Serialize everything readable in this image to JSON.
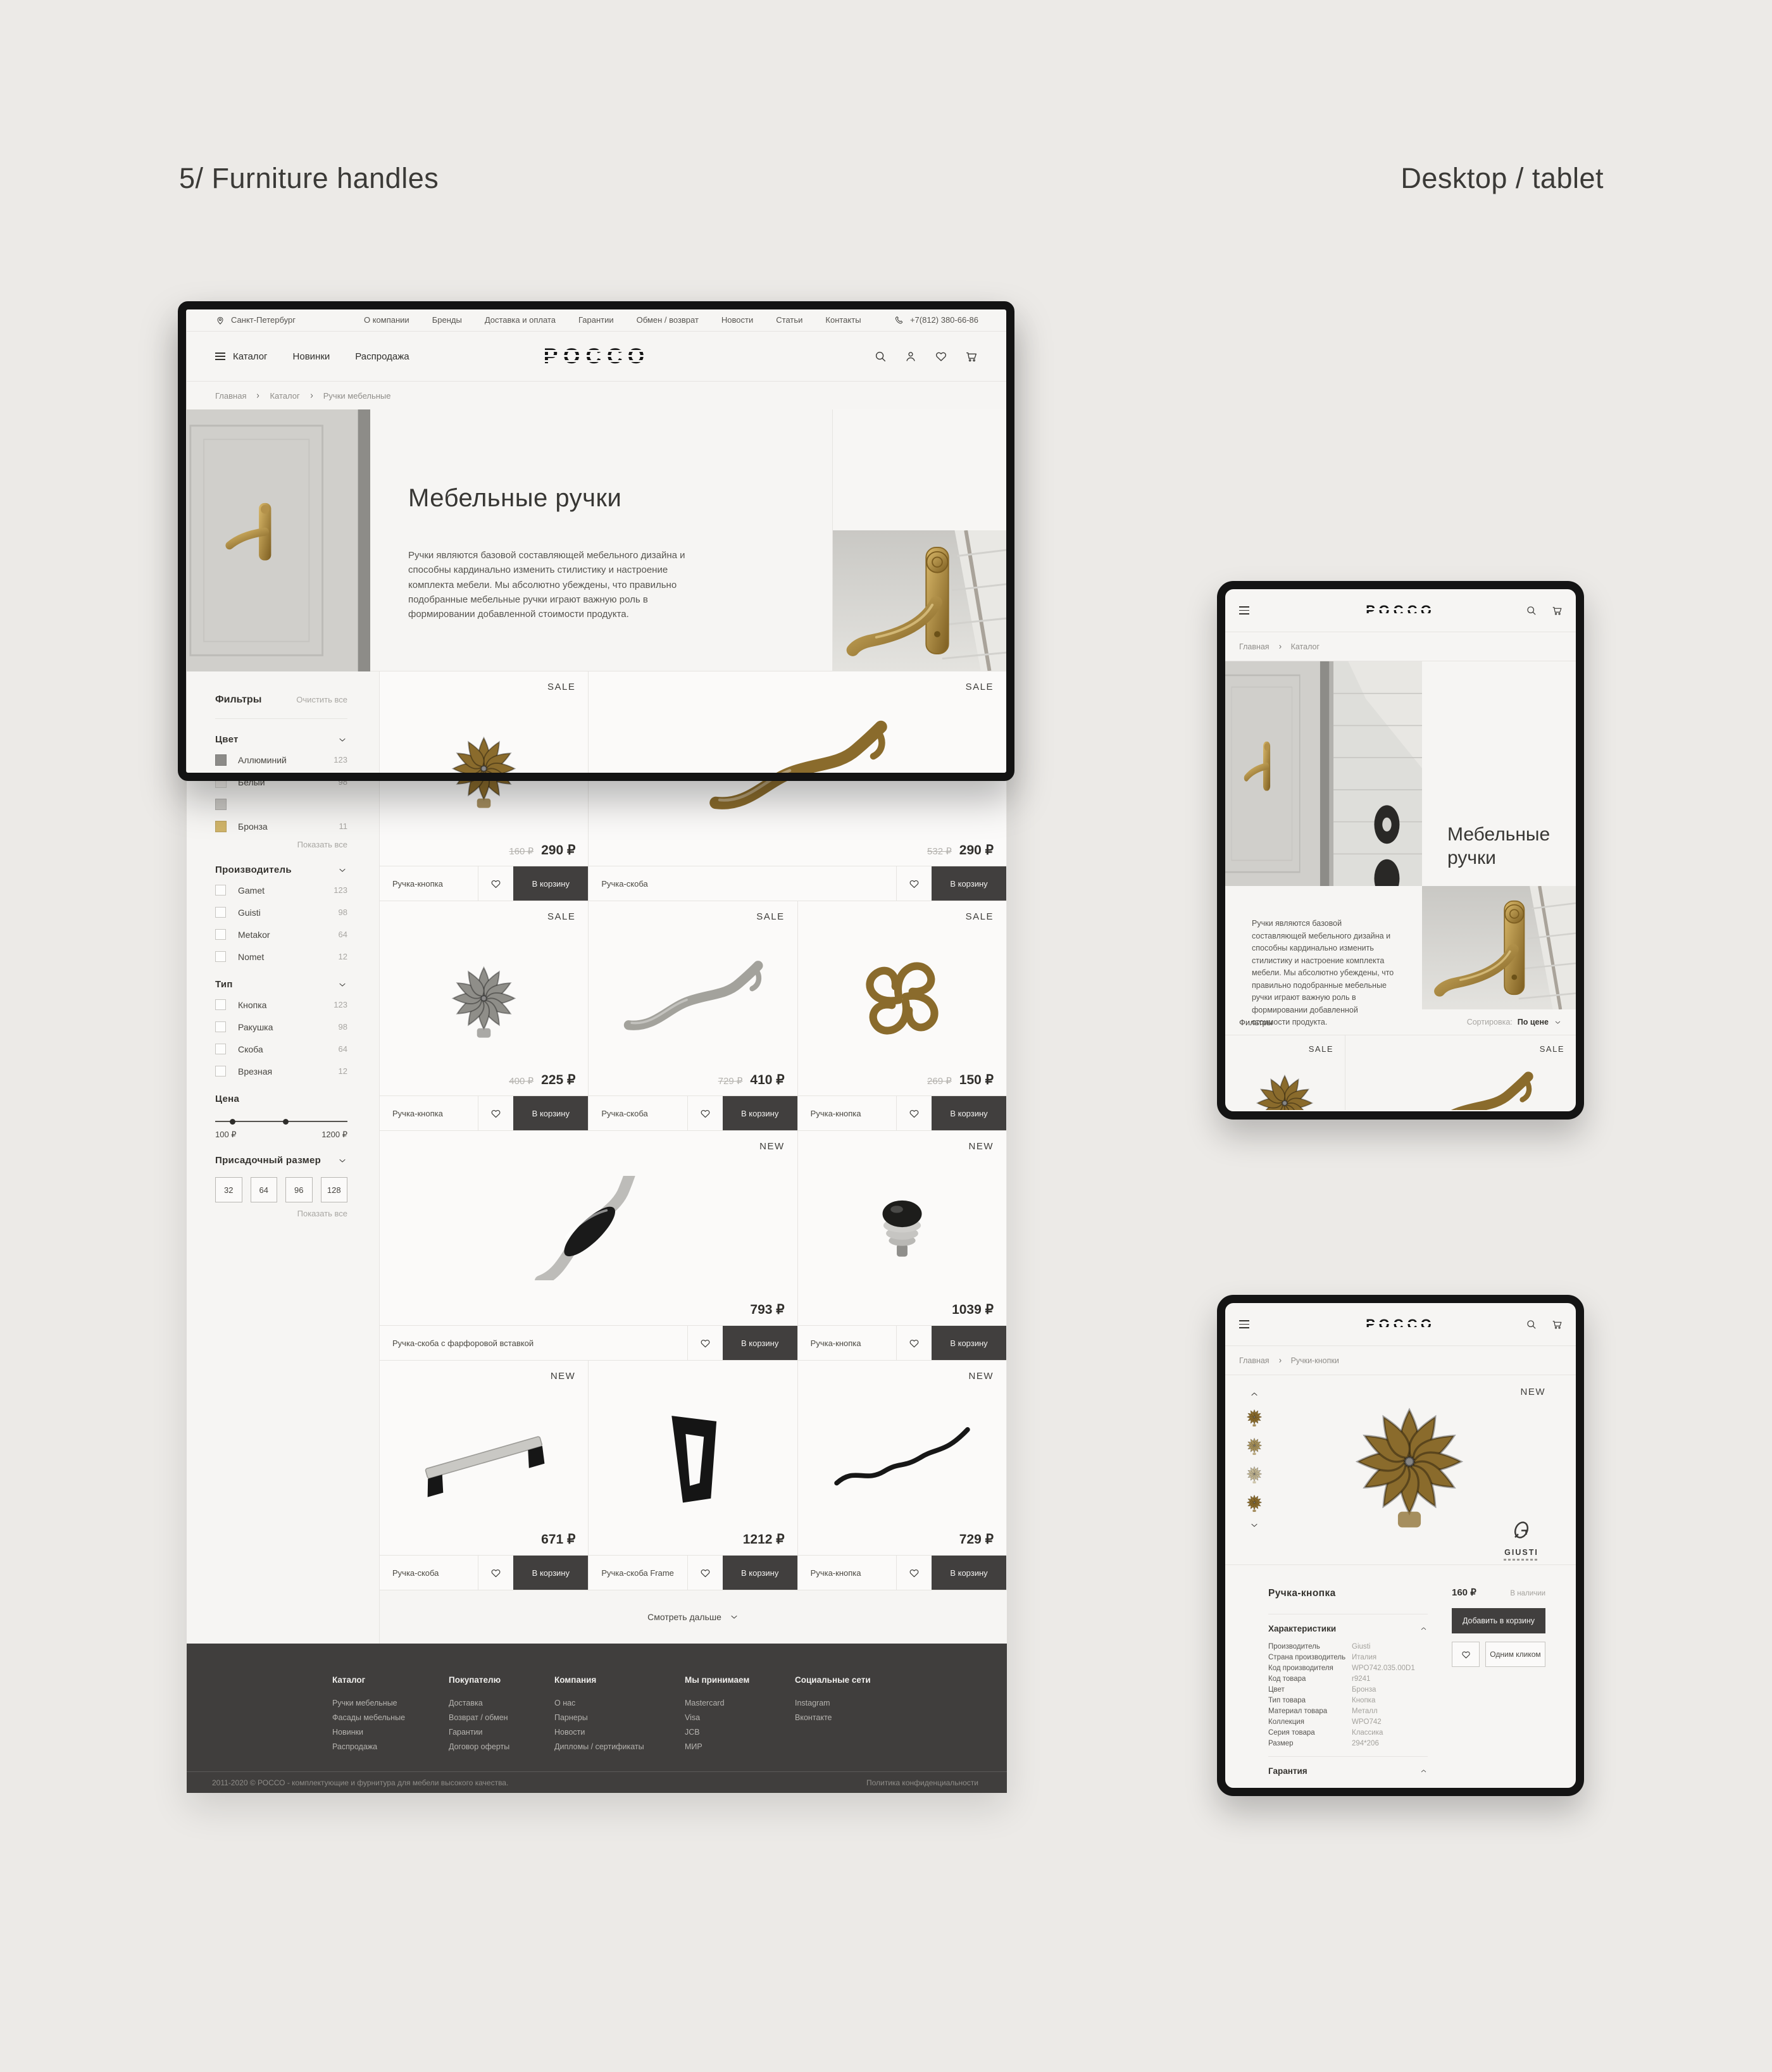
{
  "meta": {
    "title": "5/ Furniture handles",
    "device_label": "Desktop / tablet"
  },
  "topbar": {
    "city": "Санкт-Петербург",
    "links": [
      "О компании",
      "Бренды",
      "Доставка и оплата",
      "Гарантии",
      "Обмен / возврат",
      "Новости",
      "Статьи",
      "Контакты"
    ],
    "phone": "+7(812) 380-66-86"
  },
  "nav": {
    "logo": "РОССО",
    "items": [
      "Каталог",
      "Новинки",
      "Распродажа"
    ]
  },
  "breadcrumb": [
    "Главная",
    "Каталог",
    "Ручки мебельные"
  ],
  "hero": {
    "title": "Мебельные ручки",
    "description": "Ручки являются базовой составляющей мебельного дизайна и способны кардинально изменить стилистику и настроение комплекта мебели. Мы абсолютно убеждены, что правильно подобранные мебельные ручки играют важную роль в формировании добавленной стоимости продукта."
  },
  "filters": {
    "title": "Фильтры",
    "clear_all": "Очистить все",
    "show_all": "Показать все",
    "color": {
      "title": "Цвет",
      "items": [
        {
          "label": "Аллюминий",
          "count": "123",
          "swatch": "#8c8b88"
        },
        {
          "label": "Белый",
          "count": "98",
          "swatch": "#edebe7"
        },
        {
          "label": "",
          "count": "",
          "swatch": "#c9c7c3"
        },
        {
          "label": "Бронза",
          "count": "11",
          "swatch": "#d0b469"
        }
      ]
    },
    "manufacturer": {
      "title": "Производитель",
      "items": [
        {
          "label": "Gamet",
          "count": "123"
        },
        {
          "label": "Guisti",
          "count": "98"
        },
        {
          "label": "Metakor",
          "count": "64"
        },
        {
          "label": "Nomet",
          "count": "12"
        }
      ]
    },
    "type": {
      "title": "Тип",
      "items": [
        {
          "label": "Кнопка",
          "count": "123"
        },
        {
          "label": "Ракушка",
          "count": "98"
        },
        {
          "label": "Скоба",
          "count": "64"
        },
        {
          "label": "Врезная",
          "count": "12"
        }
      ]
    },
    "price": {
      "title": "Цена",
      "min": "100 ₽",
      "max": "1200 ₽"
    },
    "size": {
      "title": "Присадочный размер",
      "options": [
        "32",
        "64",
        "96",
        "128"
      ]
    }
  },
  "products": {
    "add_to_cart": "В корзину",
    "load_more": "Смотреть дальше",
    "items": [
      {
        "badge": "SALE",
        "old_price": "160 ₽",
        "price": "290 ₽",
        "label": "Ручка-кнопка",
        "img": "knob-flower-brass"
      },
      {
        "badge": "SALE",
        "old_price": "532 ₽",
        "price": "290 ₽",
        "label": "Ручка-скоба",
        "img": "handle-curve-brass"
      },
      {
        "badge": "SALE",
        "old_price": "400 ₽",
        "price": "225 ₽",
        "label": "Ручка-кнопка",
        "img": "knob-flower-silver"
      },
      {
        "badge": "SALE",
        "old_price": "729 ₽",
        "price": "410 ₽",
        "label": "Ручка-скоба",
        "img": "handle-curve-silver"
      },
      {
        "badge": "SALE",
        "old_price": "269 ₽",
        "price": "150 ₽",
        "label": "Ручка-кнопка",
        "img": "knob-ornate-brass"
      },
      {
        "badge": "NEW",
        "old_price": "",
        "price": "793 ₽",
        "label": "Ручка-скоба с фарфоровой вставкой",
        "img": "handle-porcelain-chrome"
      },
      {
        "badge": "NEW",
        "old_price": "",
        "price": "1039 ₽",
        "label": "Ручка-кнопка",
        "img": "knob-chrome-black"
      },
      {
        "badge": "NEW",
        "old_price": "",
        "price": "671 ₽",
        "label": "Ручка-скоба",
        "img": "handle-bar-steel"
      },
      {
        "badge": "",
        "old_price": "",
        "price": "1212 ₽",
        "label": "Ручка-скоба Frame",
        "img": "handle-frame-black"
      },
      {
        "badge": "NEW",
        "old_price": "",
        "price": "729 ₽",
        "label": "Ручка-кнопка",
        "img": "handle-wave-black"
      }
    ]
  },
  "footer": {
    "columns": [
      {
        "title": "Каталог",
        "links": [
          "Ручки мебельные",
          "Фасады мебельные",
          "Новинки",
          "Распродажа"
        ]
      },
      {
        "title": "Покупателю",
        "links": [
          "Доставка",
          "Возврат / обмен",
          "Гарантии",
          "Договор оферты"
        ]
      },
      {
        "title": "Компания",
        "links": [
          "О нас",
          "Парнеры",
          "Новости",
          "Дипломы / сертификаты"
        ]
      },
      {
        "title": "Мы принимаем",
        "links": [
          "Mastercard",
          "Visa",
          "JCB",
          "МИР"
        ]
      },
      {
        "title": "Социальные сети",
        "links": [
          "Instagram",
          "Вконтакте"
        ]
      }
    ],
    "copyright": "2011-2020 © РОССО - комплектующие и фурнитура для мебели высокого качества.",
    "privacy": "Политика конфиденциальности"
  },
  "tablet_catalog": {
    "breadcrumb": [
      "Главная",
      "Каталог"
    ],
    "title": "Мебельные ручки",
    "description": "Ручки являются базовой составляющей мебельного дизайна и способны кардинально изменить стилистику и настроение комплекта мебели. Мы абсолютно убеждены, что правильно подобранные мебельные ручки играют важную роль в формировании добавленной стоимости продукта.",
    "filters_label": "Фильтры",
    "sort_label": "Сортировка:",
    "sort_value": "По цене",
    "cards": [
      {
        "badge": "SALE"
      },
      {
        "badge": "SALE"
      }
    ]
  },
  "tablet_product": {
    "breadcrumb": [
      "Главная",
      "Ручки-кнопки"
    ],
    "badge": "NEW",
    "brand": "GIUSTI",
    "title": "Ручка-кнопка",
    "price": "160 ₽",
    "availability": "В наличии",
    "add_to_cart": "Добавить в корзину",
    "one_click": "Одним кликом",
    "specs_title": "Характеристики",
    "specs": [
      {
        "name": "Производитель",
        "value": "Giusti"
      },
      {
        "name": "Страна производитель",
        "value": "Италия"
      },
      {
        "name": "Код производителя",
        "value": "WPO742.035.00D1"
      },
      {
        "name": "Код товара",
        "value": "r9241"
      },
      {
        "name": "Цвет",
        "value": "Бронза"
      },
      {
        "name": "Тип товара",
        "value": "Кнопка"
      },
      {
        "name": "Материал товара",
        "value": "Металл"
      },
      {
        "name": "Коллекция",
        "value": "WPO742"
      },
      {
        "name": "Серия товара",
        "value": "Классика"
      },
      {
        "name": "Размер",
        "value": "294*206"
      }
    ],
    "warranty_title": "Гарантия"
  }
}
